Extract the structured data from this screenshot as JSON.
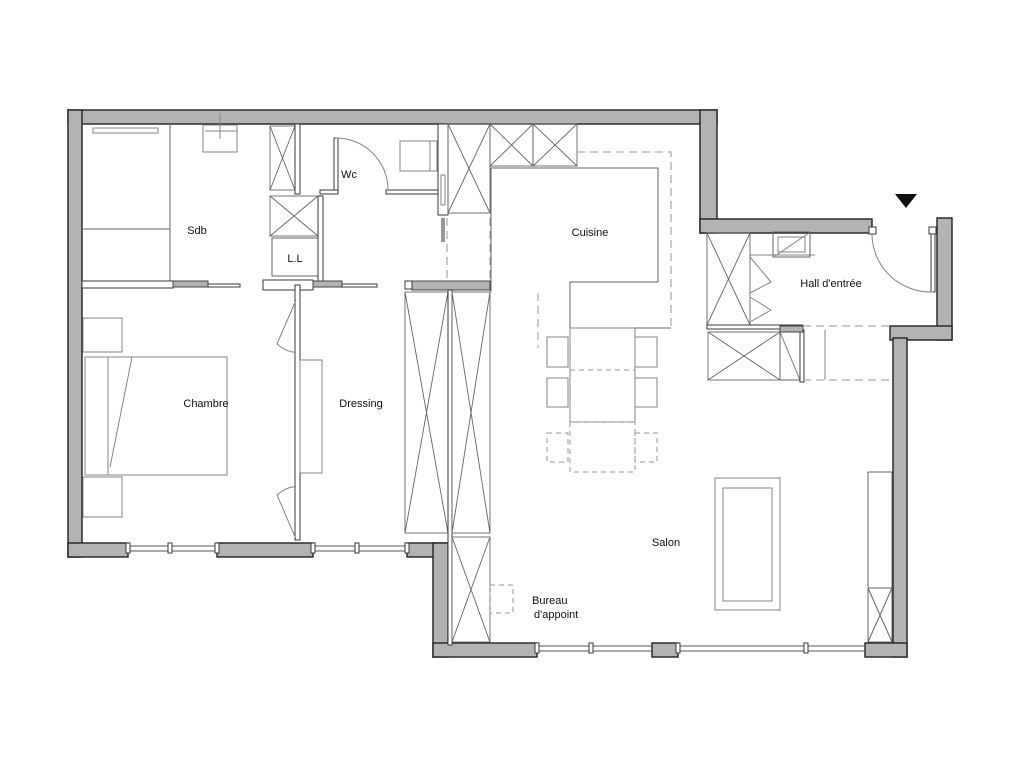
{
  "title": "Apartment floor plan",
  "colors": {
    "wall-fill": "#b3b3b3",
    "wall-stroke": "#222222",
    "line": "#555555",
    "furniture": "#858585",
    "dashed": "#999999",
    "text": "#111111",
    "background": "#ffffff"
  },
  "rooms": {
    "sdb": {
      "label": "Sdb"
    },
    "wc": {
      "label": "Wc"
    },
    "ll": {
      "label": "L.L"
    },
    "cuisine": {
      "label": "Cuisine"
    },
    "hall": {
      "label": "Hall d'entrée"
    },
    "chambre": {
      "label": "Chambre"
    },
    "dressing": {
      "label": "Dressing"
    },
    "salon": {
      "label": "Salon"
    },
    "bureau": {
      "label_line1": "Bureau",
      "label_line2": "d'appoint"
    }
  },
  "icons": {
    "entrance_marker": "down-triangle"
  }
}
